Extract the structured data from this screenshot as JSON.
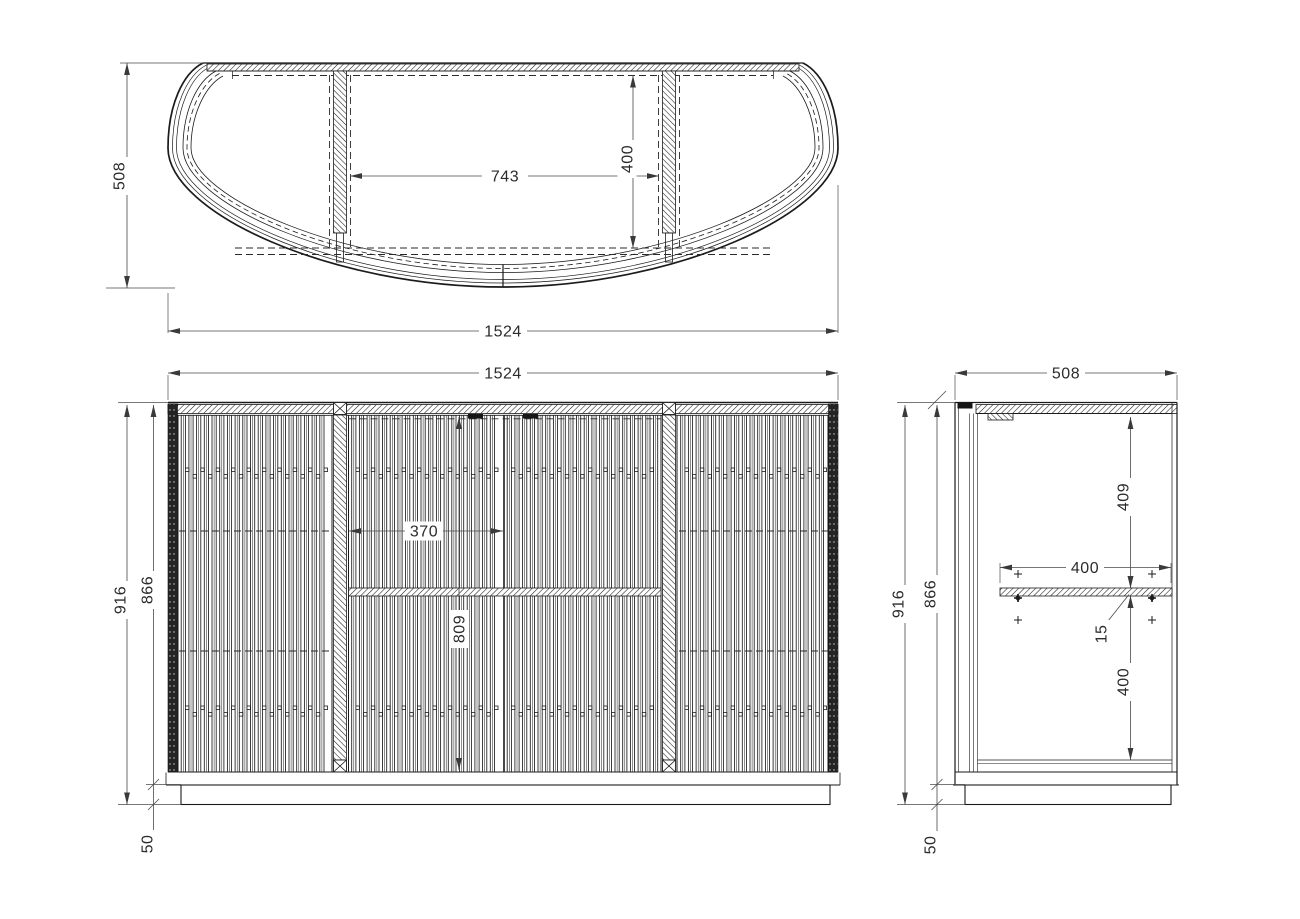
{
  "views": {
    "top": {
      "dims": {
        "depth": "508",
        "width": "1524",
        "inner_width": "743",
        "inner_depth": "400"
      }
    },
    "front": {
      "dims": {
        "width": "1524",
        "height": "916",
        "body_height": "866",
        "door_width": "370",
        "interior_height": "809",
        "plinth_height": "50"
      }
    },
    "side": {
      "dims": {
        "depth": "508",
        "height": "916",
        "body_height": "866",
        "shelf_from_top": "409",
        "shelf_depth": "400",
        "shelf_thickness": "15",
        "shelf_to_bottom": "400",
        "plinth_height": "50"
      }
    }
  },
  "colors": {
    "background": "#ffffff",
    "object_line": "#1b1b1b",
    "dimension_line": "#4a4a4a"
  }
}
